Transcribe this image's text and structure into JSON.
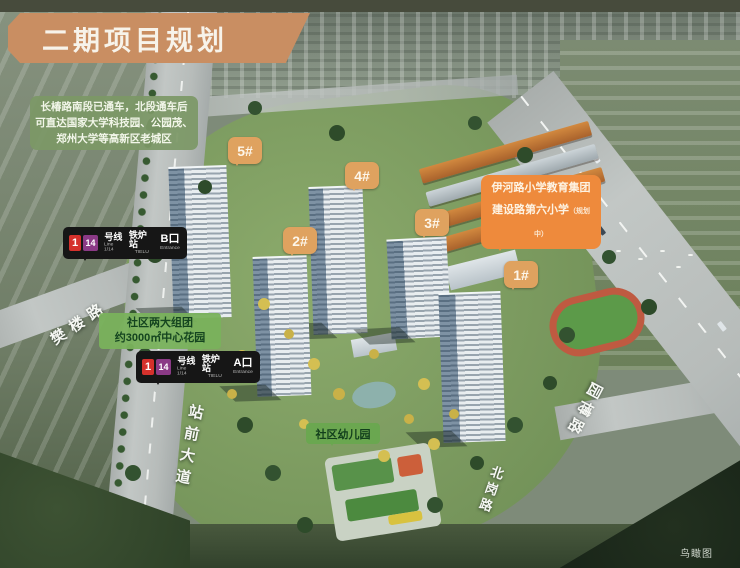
{
  "title_banner": {
    "text": "二期项目规划"
  },
  "info_box": {
    "lines": [
      "长椿路南段已通车，北段通车后",
      "可直达国家大学科技园、公园茂、",
      "郑州大学等高新区老城区"
    ]
  },
  "building_labels": [
    {
      "id": "5#"
    },
    {
      "id": "4#"
    },
    {
      "id": "3#"
    },
    {
      "id": "2#"
    },
    {
      "id": "1#"
    }
  ],
  "metro_labels": [
    {
      "badge_line1": "1",
      "badge_line14": "14",
      "line_cn": "号线",
      "line_en": "Line 1/14",
      "station_cn": "铁炉站",
      "station_en": "TIELU",
      "exit_cn": "B口",
      "exit_en": "Entrance"
    },
    {
      "badge_line1": "1",
      "badge_line14": "14",
      "line_cn": "号线",
      "line_en": "Line 1/14",
      "station_cn": "铁炉站",
      "station_en": "TIELU",
      "exit_cn": "A口",
      "exit_en": "Entrance"
    }
  ],
  "school_box": {
    "line1": "伊河路小学教育集团",
    "line2": "建设路第六小学",
    "note": "（规划中）"
  },
  "garden_box": {
    "line1": "社区两大组团",
    "line2": "约3000㎡中心花园"
  },
  "kindergarten_box": {
    "text": "社区幼儿园"
  },
  "road_labels": [
    {
      "text": "樊楼路"
    },
    {
      "text": "站前大道"
    },
    {
      "text": "北岗路"
    },
    {
      "text": "园博路"
    }
  ],
  "caption": {
    "text": "鸟瞰图"
  },
  "colors": {
    "banner_orange": "#c98e62",
    "bubble_orange": "#dfa25f",
    "school_orange": "#ee8a3c",
    "metro_black": "#161616",
    "line1_red": "#d5312c",
    "line14_purple": "#8b3a86",
    "info_green": "#7c9866",
    "callout_green": "#79b25c",
    "site_green": "#7b9a5f"
  }
}
